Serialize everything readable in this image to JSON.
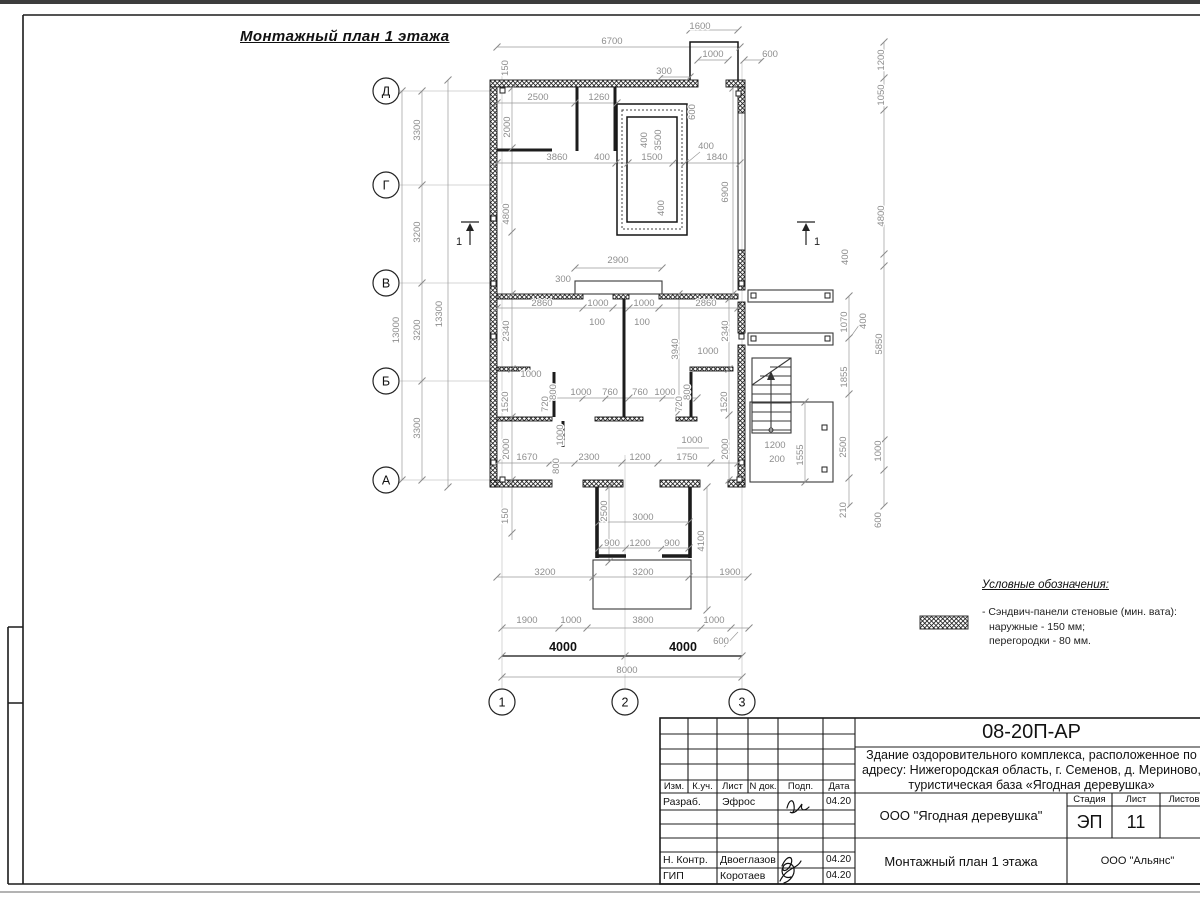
{
  "sheet": {
    "title": "Монтажный план 1 этажа",
    "legend": {
      "title": "Условные обозначения:",
      "item_line1": "- Сэндвич-панели стеновые (мин. вата):",
      "item_line2": "наружные - 150 мм;",
      "item_line3": "перегородки - 80 мм."
    }
  },
  "axes": {
    "rows": [
      "Д",
      "Г",
      "В",
      "Б",
      "А"
    ],
    "cols": [
      "1",
      "2",
      "3"
    ]
  },
  "section_marks": [
    "1",
    "1"
  ],
  "plan": {
    "dim_labels": [
      {
        "t": "1600",
        "x": 700,
        "y": 29
      },
      {
        "t": "6700",
        "x": 612,
        "y": 44
      },
      {
        "t": "1000",
        "x": 713,
        "y": 57
      },
      {
        "t": "600",
        "x": 770,
        "y": 57
      },
      {
        "t": "300",
        "x": 664,
        "y": 74
      },
      {
        "t": "150",
        "x": 508,
        "y": 68,
        "v": 1
      },
      {
        "t": "2500",
        "x": 538,
        "y": 100
      },
      {
        "t": "1260",
        "x": 599,
        "y": 100
      },
      {
        "t": "2000",
        "x": 510,
        "y": 127,
        "v": 1
      },
      {
        "t": "600",
        "x": 695,
        "y": 112,
        "v": 1
      },
      {
        "t": "400",
        "x": 647,
        "y": 140,
        "v": 1
      },
      {
        "t": "3500",
        "x": 661,
        "y": 140,
        "v": 1
      },
      {
        "t": "3860",
        "x": 557,
        "y": 160
      },
      {
        "t": "400",
        "x": 602,
        "y": 160
      },
      {
        "t": "1500",
        "x": 652,
        "y": 160
      },
      {
        "t": "400",
        "x": 706,
        "y": 149
      },
      {
        "t": "1840",
        "x": 717,
        "y": 160
      },
      {
        "t": "6900",
        "x": 728,
        "y": 192,
        "v": 1
      },
      {
        "t": "400",
        "x": 664,
        "y": 208,
        "v": 1
      },
      {
        "t": "4800",
        "x": 509,
        "y": 214,
        "v": 1
      },
      {
        "t": "1200",
        "x": 884,
        "y": 60,
        "v": 1
      },
      {
        "t": "1050",
        "x": 884,
        "y": 95,
        "v": 1
      },
      {
        "t": "4800",
        "x": 884,
        "y": 216,
        "v": 1
      },
      {
        "t": "400",
        "x": 848,
        "y": 257,
        "v": 1
      },
      {
        "t": "2900",
        "x": 618,
        "y": 263
      },
      {
        "t": "300",
        "x": 563,
        "y": 282
      },
      {
        "t": "2860",
        "x": 542,
        "y": 306
      },
      {
        "t": "1000",
        "x": 598,
        "y": 306
      },
      {
        "t": "1000",
        "x": 644,
        "y": 306
      },
      {
        "t": "2860",
        "x": 706,
        "y": 306
      },
      {
        "t": "100",
        "x": 597,
        "y": 325
      },
      {
        "t": "100",
        "x": 642,
        "y": 325
      },
      {
        "t": "2340",
        "x": 509,
        "y": 331,
        "v": 1
      },
      {
        "t": "2340",
        "x": 728,
        "y": 331,
        "v": 1
      },
      {
        "t": "3940",
        "x": 678,
        "y": 349,
        "v": 1
      },
      {
        "t": "1000",
        "x": 708,
        "y": 354
      },
      {
        "t": "1070",
        "x": 847,
        "y": 322,
        "v": 1
      },
      {
        "t": "400",
        "x": 866,
        "y": 321,
        "v": 1
      },
      {
        "t": "5850",
        "x": 882,
        "y": 344,
        "v": 1
      },
      {
        "t": "1855",
        "x": 847,
        "y": 377,
        "v": 1
      },
      {
        "t": "1000",
        "x": 531,
        "y": 377
      },
      {
        "t": "800",
        "x": 556,
        "y": 392,
        "v": 1
      },
      {
        "t": "720",
        "x": 548,
        "y": 404,
        "v": 1
      },
      {
        "t": "1520",
        "x": 508,
        "y": 402,
        "v": 1
      },
      {
        "t": "1000",
        "x": 581,
        "y": 395
      },
      {
        "t": "760",
        "x": 610,
        "y": 395
      },
      {
        "t": "760",
        "x": 640,
        "y": 395
      },
      {
        "t": "1000",
        "x": 665,
        "y": 395
      },
      {
        "t": "800",
        "x": 690,
        "y": 392,
        "v": 1
      },
      {
        "t": "720",
        "x": 682,
        "y": 404,
        "v": 1
      },
      {
        "t": "1520",
        "x": 727,
        "y": 402,
        "v": 1
      },
      {
        "t": "2000",
        "x": 509,
        "y": 449,
        "v": 1
      },
      {
        "t": "2000",
        "x": 728,
        "y": 449,
        "v": 1
      },
      {
        "t": "1000",
        "x": 563,
        "y": 435,
        "v": 1
      },
      {
        "t": "1000",
        "x": 692,
        "y": 443
      },
      {
        "t": "2500",
        "x": 846,
        "y": 447,
        "v": 1
      },
      {
        "t": "1000",
        "x": 881,
        "y": 451,
        "v": 1
      },
      {
        "t": "1555",
        "x": 803,
        "y": 455,
        "v": 1
      },
      {
        "t": "1200",
        "x": 775,
        "y": 448
      },
      {
        "t": "200",
        "x": 777,
        "y": 462
      },
      {
        "t": "1670",
        "x": 527,
        "y": 460
      },
      {
        "t": "800",
        "x": 559,
        "y": 466,
        "v": 1
      },
      {
        "t": "2300",
        "x": 589,
        "y": 460
      },
      {
        "t": "1200",
        "x": 640,
        "y": 460
      },
      {
        "t": "1750",
        "x": 687,
        "y": 460
      },
      {
        "t": "210",
        "x": 846,
        "y": 510,
        "v": 1
      },
      {
        "t": "600",
        "x": 881,
        "y": 520,
        "v": 1
      },
      {
        "t": "150",
        "x": 508,
        "y": 516,
        "v": 1
      },
      {
        "t": "2500",
        "x": 607,
        "y": 511,
        "v": 1
      },
      {
        "t": "3000",
        "x": 643,
        "y": 520
      },
      {
        "t": "900",
        "x": 612,
        "y": 546
      },
      {
        "t": "1200",
        "x": 640,
        "y": 546
      },
      {
        "t": "900",
        "x": 672,
        "y": 546
      },
      {
        "t": "4100",
        "x": 704,
        "y": 541,
        "v": 1
      },
      {
        "t": "3200",
        "x": 545,
        "y": 575
      },
      {
        "t": "3200",
        "x": 643,
        "y": 575
      },
      {
        "t": "1900",
        "x": 730,
        "y": 575
      },
      {
        "t": "1900",
        "x": 527,
        "y": 623
      },
      {
        "t": "1000",
        "x": 571,
        "y": 623
      },
      {
        "t": "3800",
        "x": 643,
        "y": 623
      },
      {
        "t": "1000",
        "x": 714,
        "y": 623
      },
      {
        "t": "600",
        "x": 721,
        "y": 644
      },
      {
        "t": "4000",
        "x": 563,
        "y": 651,
        "b": 1
      },
      {
        "t": "4000",
        "x": 683,
        "y": 651,
        "b": 1
      },
      {
        "t": "8000",
        "x": 627,
        "y": 673
      },
      {
        "t": "3300",
        "x": 420,
        "y": 130,
        "v": 1
      },
      {
        "t": "3200",
        "x": 420,
        "y": 232,
        "v": 1
      },
      {
        "t": "3200",
        "x": 420,
        "y": 330,
        "v": 1
      },
      {
        "t": "3300",
        "x": 420,
        "y": 428,
        "v": 1
      },
      {
        "t": "13000",
        "x": 399,
        "y": 330,
        "v": 1
      },
      {
        "t": "13300",
        "x": 442,
        "y": 314,
        "v": 1
      }
    ]
  },
  "title_block": {
    "doc_number": "08-20П-АР",
    "project_line1": "Здание оздоровительного комплекса, расположенное по",
    "project_line2": "адресу: Нижегородская область, г. Семенов, д. Мериново,",
    "project_line3": "туристическая база «Ягодная деревушка»",
    "header_cols": [
      "Изм.",
      "К.уч.",
      "Лист",
      "N док.",
      "Подп.",
      "Дата"
    ],
    "sig_rows": [
      {
        "role": "Разраб.",
        "name": "Эфрос",
        "date": "04.20"
      },
      {
        "role": "Н. Контр.",
        "name": "Двоеглазов",
        "date": "04.20"
      },
      {
        "role": "ГИП",
        "name": "Коротаев",
        "date": "04.20"
      }
    ],
    "org1": "ООО \"Ягодная деревушка\"",
    "stage_label": "Стадия",
    "sheet_label": "Лист",
    "sheets_label": "Листов",
    "stage": "ЭП",
    "sheet_num": "11",
    "drawing_title": "Монтажный план 1 этажа",
    "org2": "ООО \"Альянс\""
  }
}
